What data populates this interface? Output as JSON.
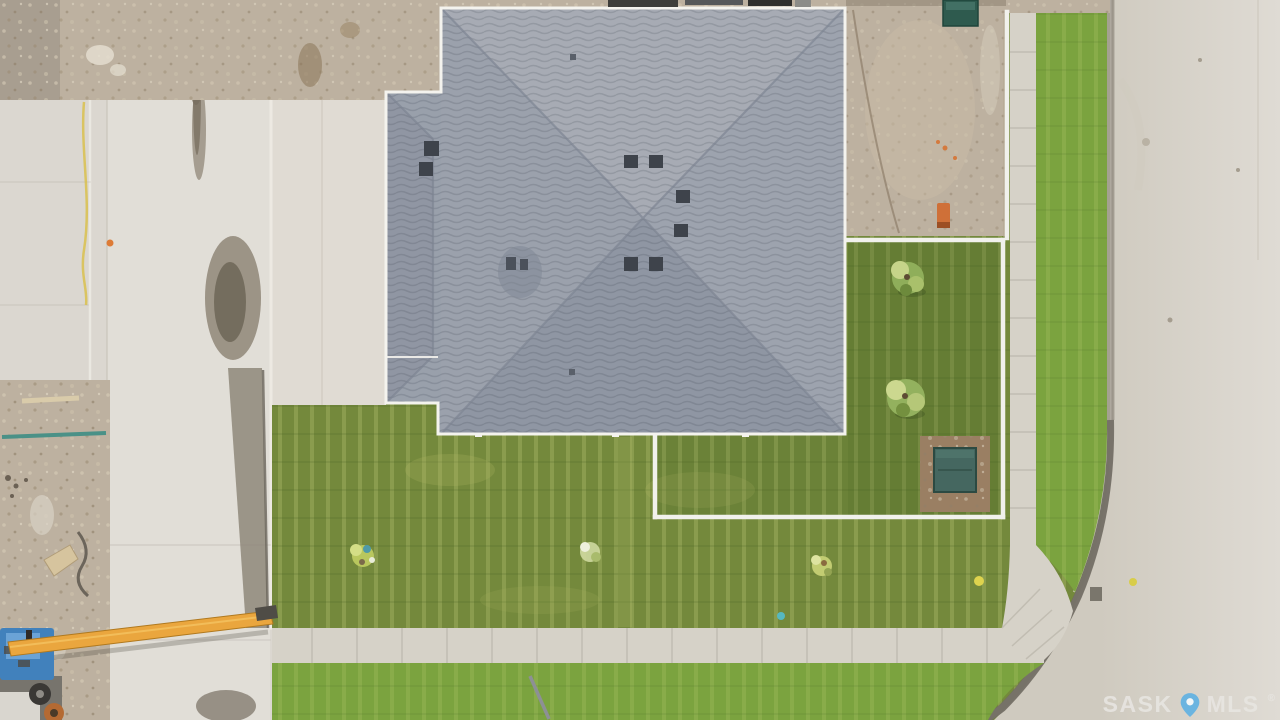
{
  "scene": {
    "description": "Aerial top-down drone photo of a newly built house with a gray hip roof on a corner lot: fresh sod lawn, white vinyl fence side yard with two small trees and a utility box, concrete lane and driveway on the left, curved street with sidewalk and boulevard grass on the right, neighbouring dirt construction lots, and a blue boom lift with a long yellow boom at the lower left"
  },
  "watermark": {
    "brand_left": "SASK",
    "brand_right": "MLS",
    "registered_mark": "®",
    "pin_icon": "location-pin-icon"
  },
  "colors": {
    "concrete": "#dbd7d0",
    "lane": "#e1ded7",
    "road_near": "#cfcabf",
    "road_far": "#dfdbd4",
    "sidewalk": "#d6d2c8",
    "joint": "#bdb8ad",
    "curb_light": "#aaa49a",
    "curb_dark": "#6f6a60",
    "dirt": "#bdb1a0",
    "gravel_corner": "#a89e90",
    "grass": "#74893c",
    "grass_boulevard": "#7ba33f",
    "roof_base": "#99a0ab",
    "roof_north": "#a7abb4",
    "roof_east": "#9da3ae",
    "roof_south": "#8f96a3",
    "roof_west": "#9ba1ac",
    "garage_west": "#9096a3",
    "fascia": "#f4f3ee",
    "ridge": "#7d8492",
    "vent": "#3e434b",
    "fence": "#f1f1ec",
    "mulch": "#9a7f63",
    "utility_box": "#456760",
    "utility_box_dark": "#2e5a4e",
    "machine_blue": "#4181bc",
    "boom_yellow": "#eaa63e",
    "stain": "#8b8172",
    "pipe_teal": "#4a9187",
    "pipe_orange": "#cf7038",
    "hose_yellow": "#d9c14d",
    "watermark_text": "#e8e6e2",
    "watermark_pin": "#5bb0e4"
  }
}
